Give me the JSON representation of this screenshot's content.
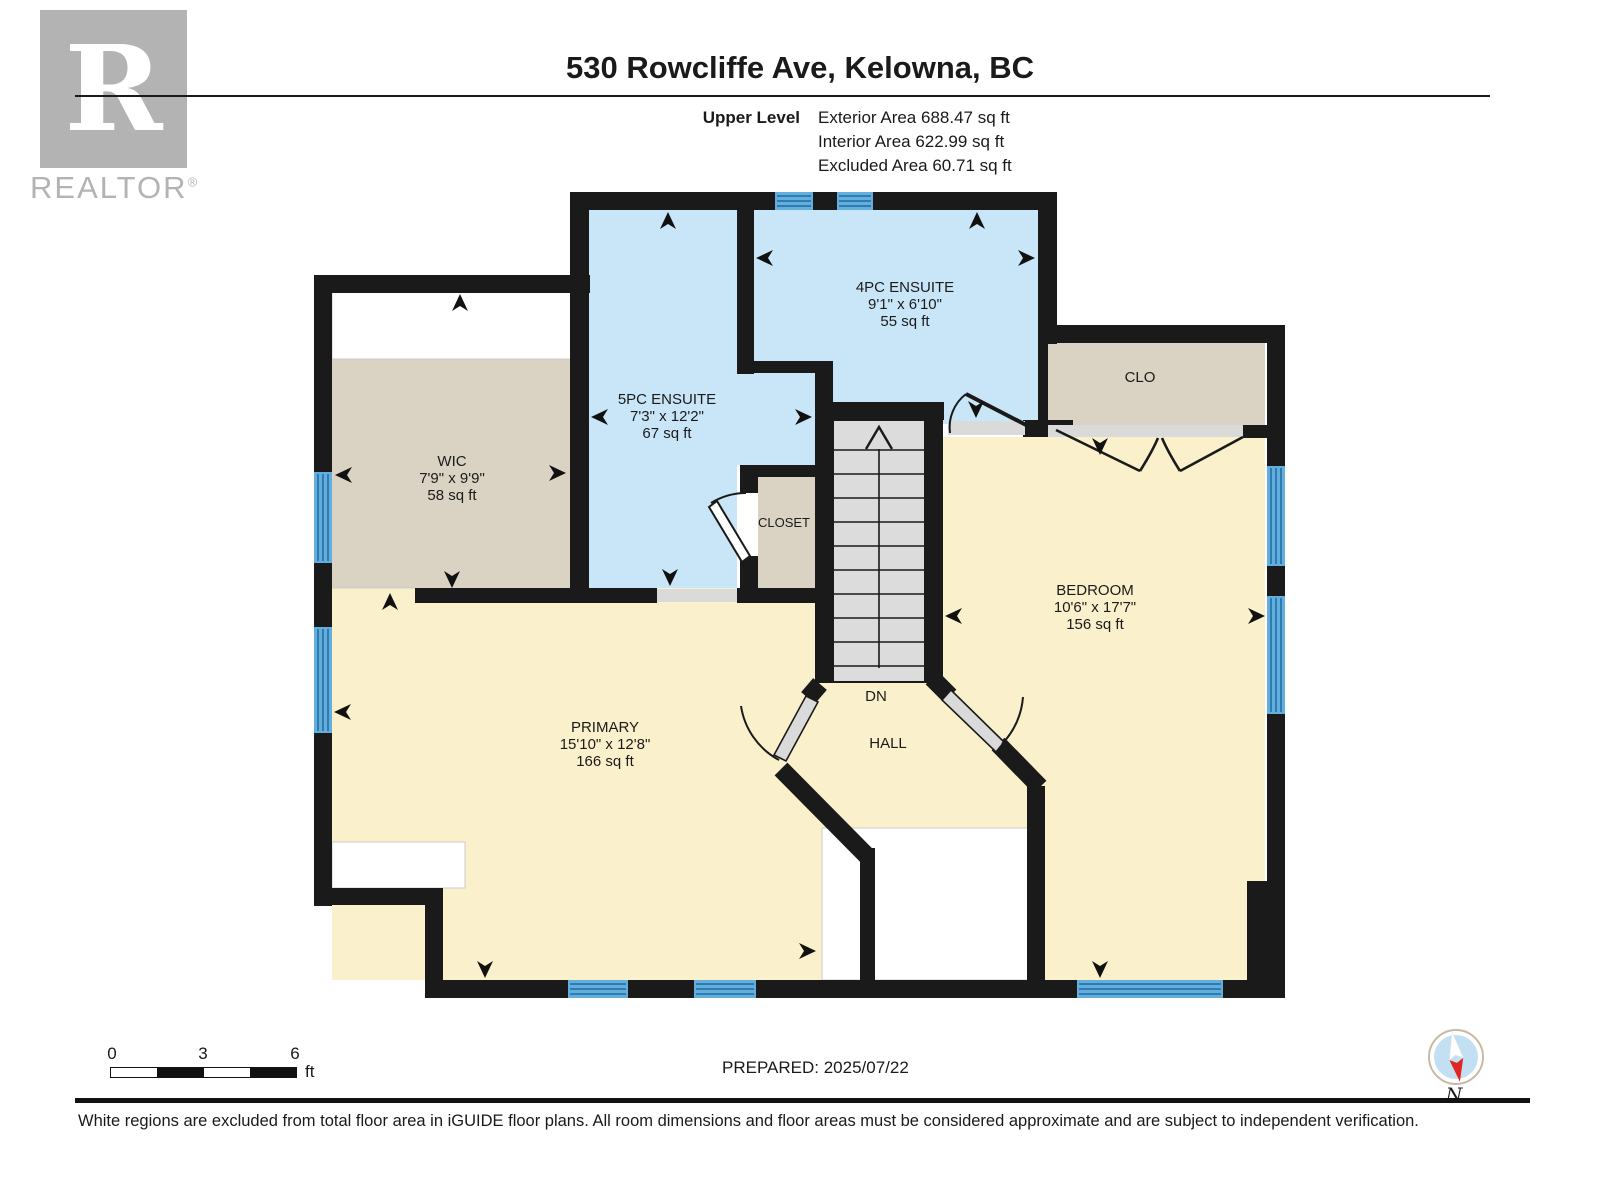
{
  "header": {
    "address": "530 Rowcliffe Ave, Kelowna, BC",
    "level_label": "Upper Level",
    "area_lines": [
      "Exterior Area 688.47 sq ft",
      "Interior Area 622.99 sq ft",
      "Excluded Area 60.71 sq ft"
    ]
  },
  "logo": {
    "mark": "R",
    "brand": "REALTOR",
    "registered": "®"
  },
  "rooms": {
    "wic": {
      "name": "WIC",
      "dims": "7'9\" x 9'9\"",
      "area": "58 sq ft"
    },
    "ensuite5pc": {
      "name": "5PC ENSUITE",
      "dims": "7'3\" x 12'2\"",
      "area": "67 sq ft"
    },
    "ensuite4pc": {
      "name": "4PC ENSUITE",
      "dims": "9'1\" x 6'10\"",
      "area": "55 sq ft"
    },
    "clo": {
      "name": "CLO"
    },
    "closet": {
      "name": "CLOSET"
    },
    "bedroom": {
      "name": "BEDROOM",
      "dims": "10'6\" x 17'7\"",
      "area": "156 sq ft"
    },
    "primary": {
      "name": "PRIMARY",
      "dims": "15'10\" x 12'8\"",
      "area": "166 sq ft"
    },
    "hall": {
      "name": "HALL"
    },
    "stairs_label": "DN"
  },
  "scale_bar": {
    "ticks": [
      "0",
      "3",
      "6"
    ],
    "unit": "ft"
  },
  "prepared": "PREPARED: 2025/07/22",
  "compass": {
    "north_label": "N"
  },
  "footer": {
    "disclaimer": "White regions are excluded from total floor area in iGUIDE floor plans. All room dimensions and floor areas must be considered approximate and are subject to independent verification."
  },
  "colors": {
    "wall": "#1a1a1a",
    "room-blue": "#c9e6f8",
    "room-tan": "#dad2c3",
    "room-cream": "#faf0cb",
    "stairs-grey": "#dcdcdc",
    "window-blue": "#63aedd",
    "window-line": "#2e7cb0",
    "door-grey": "#dadada",
    "excluded-white": "#ffffff",
    "logo-grey": "#b3b3b3",
    "compass-red": "#e02620",
    "compass-blue": "#c3dff2"
  }
}
